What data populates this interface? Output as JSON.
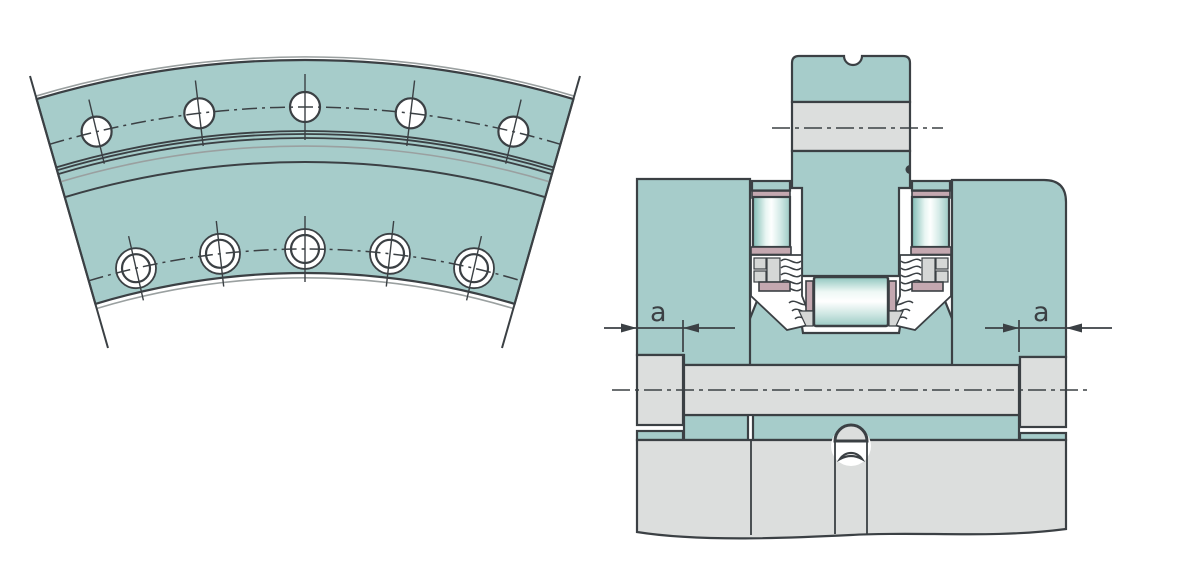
{
  "drawing": {
    "description": "Technical drawing of a slewing ring bearing: plan view of ring segment with bolt holes (left) and cross-section of axial-radial bearing arrangement (right)",
    "left_view": {
      "upper_bolt_hole_count": 5,
      "lower_bolt_hole_count": 5
    },
    "right_view": {
      "dimension_labels": {
        "left": "a",
        "right": "a"
      }
    }
  },
  "colors": {
    "part_teal": "#a6ccca",
    "part_gray": "#dcdedd",
    "seal_pink": "#c4a8b0",
    "outline_dark": "#3b4044",
    "shadow_gray": "#9aa0a0",
    "background": "#ffffff"
  }
}
